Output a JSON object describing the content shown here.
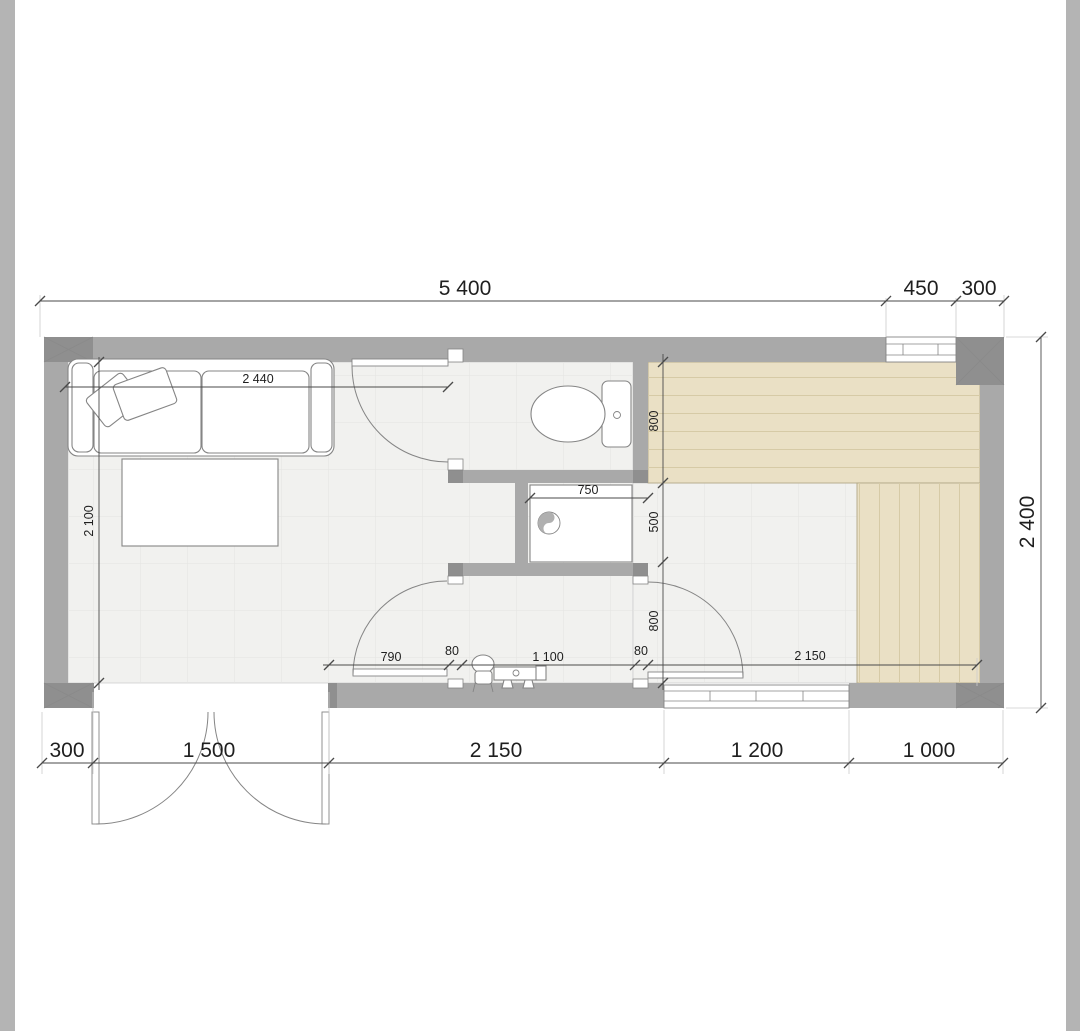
{
  "title": "floor-plan-drawing",
  "colors": {
    "edge": "#b4b4b4",
    "wall": "#a9a9a9",
    "wall_dark": "#8f8f8f",
    "wall_line": "#8a8a8a",
    "floor": "#f1f1ef",
    "grid": "#e4e4e2",
    "deck": "#eae0c5",
    "deck_line": "#d6caa6",
    "deck_edge": "#b3a988",
    "stroke": "#858585",
    "dim": "#4a4a4a",
    "text": "#1f1f1f"
  },
  "dims": {
    "top_overall": "5 400",
    "top_window": "450",
    "top_corner": "300",
    "right_overall": "2 400",
    "bottom_corner": "300",
    "bottom_entry": "1 500",
    "bottom_mid": "2 150",
    "bottom_window": "1 200",
    "bottom_deck": "1 000",
    "sofa_width": "2 440",
    "left_depth": "2 100",
    "shower_width": "750",
    "wc_depth": "800",
    "shower_depth": "500",
    "hall_depth": "800",
    "seg_790": "790",
    "seg_80_left": "80",
    "seg_1100": "1 100",
    "seg_80_right": "80",
    "terrace_width": "2 150"
  }
}
